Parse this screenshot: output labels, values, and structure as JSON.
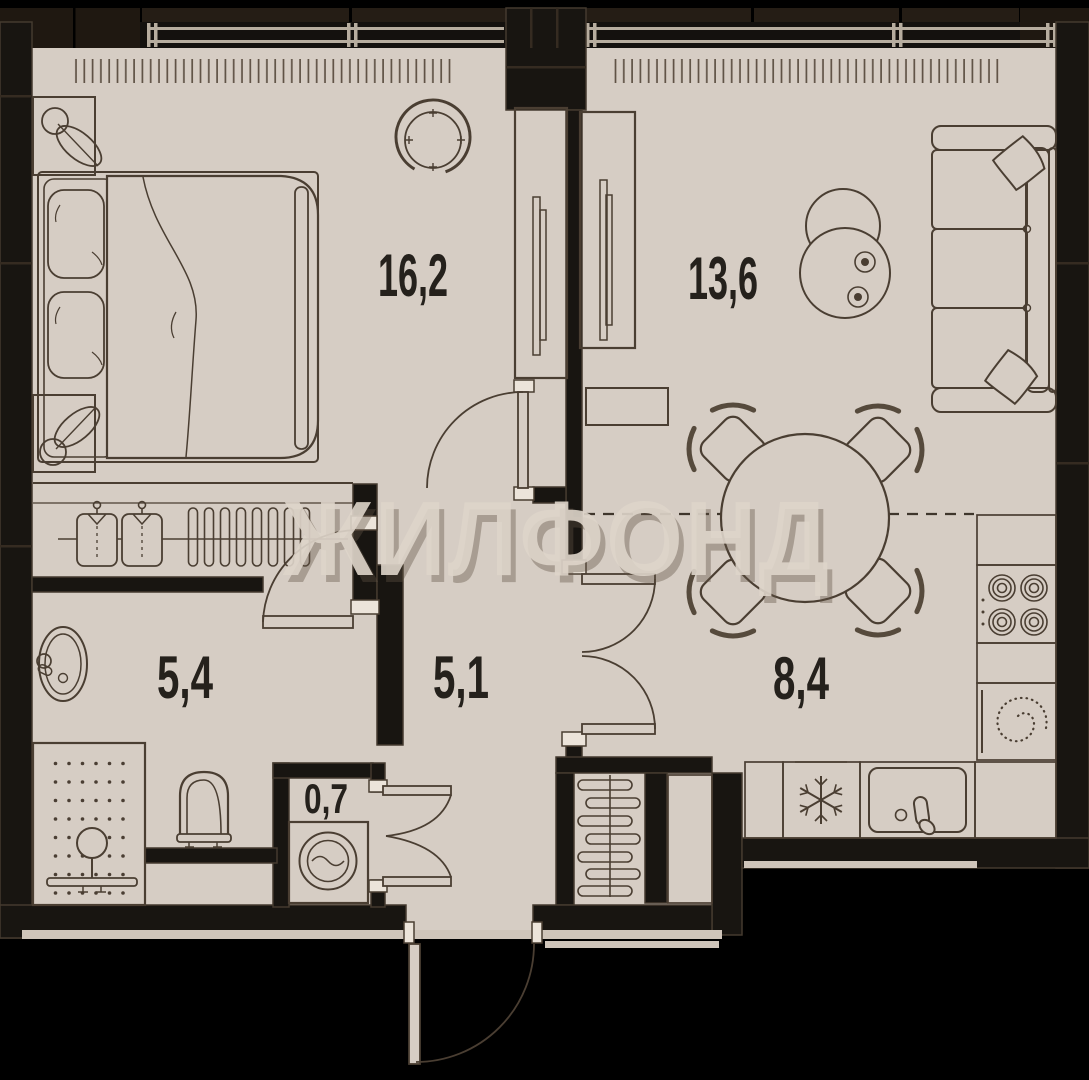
{
  "document": {
    "kind": "apartment floor plan",
    "language": "ru"
  },
  "watermark": {
    "text": "ЖИЛФОНД",
    "color": "#ded5ca"
  },
  "rooms": [
    {
      "id": "bedroom",
      "area_label": "16,2"
    },
    {
      "id": "living-room",
      "area_label": "13,6"
    },
    {
      "id": "bathroom",
      "area_label": "5,4"
    },
    {
      "id": "hallway",
      "area_label": "5,1"
    },
    {
      "id": "kitchen-dining",
      "area_label": "8,4"
    },
    {
      "id": "laundry-closet",
      "area_label": "0,7"
    }
  ],
  "furniture_icons": [
    "double-bed-icon",
    "nightstand-plant-icon",
    "round-mirror-icon",
    "wardrobe-icon",
    "hanger-rail-icon",
    "shirt-icon",
    "sofa-icon",
    "coffee-tables-icon",
    "dining-table-icon",
    "chair-icon",
    "tv-lowboard-icon",
    "stove-burners-icon",
    "cooktop-spiral-icon",
    "snowflake-fridge-icon",
    "kitchen-sink-icon",
    "bathroom-sink-icon",
    "toilet-icon",
    "shower-icon",
    "washing-machine-icon",
    "radiator-icon",
    "door-swing-icon",
    "window-icon"
  ],
  "palette": {
    "background": "#000000",
    "walls": "#181511",
    "facade_band": "#251d15",
    "floor": "#d6cdc4",
    "line": "#4a3e32",
    "jamb_cap": "#ece4da",
    "exterior_trim": "#cfc5ba",
    "window_glass_line": "#b7ad9f",
    "label_color": "#25211c"
  }
}
